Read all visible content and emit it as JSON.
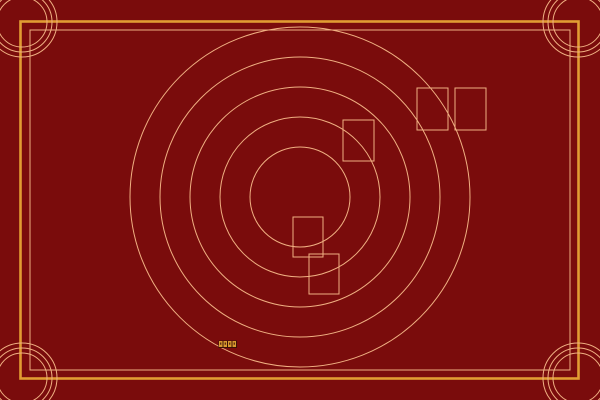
{
  "scene": {
    "width": 600,
    "height": 400,
    "background_color": "#7a0c0c",
    "line_color": "#f0b082",
    "accent_color": "#e19c33",
    "outer_border": {
      "x": 20.5,
      "y": 21.5,
      "width": 558,
      "height": 357,
      "stroke_width": 2.6
    },
    "inner_border": {
      "x": 30,
      "y": 30,
      "width": 540,
      "height": 340,
      "stroke_width": 1
    },
    "rings": {
      "cx": 300,
      "cy": 197,
      "radii": [
        50,
        80,
        110,
        140,
        170
      ],
      "stroke_width": 1
    },
    "corner_rosettes": {
      "radii": [
        25,
        30,
        35
      ],
      "stroke_width": 1,
      "centers": [
        {
          "cx": 22,
          "cy": 22
        },
        {
          "cx": 578,
          "cy": 22
        },
        {
          "cx": 22,
          "cy": 378
        },
        {
          "cx": 578,
          "cy": 378
        }
      ]
    },
    "cards": [
      {
        "x": 343,
        "y": 120,
        "width": 31,
        "height": 41
      },
      {
        "x": 417,
        "y": 88,
        "width": 31,
        "height": 42
      },
      {
        "x": 455,
        "y": 88,
        "width": 31,
        "height": 42
      },
      {
        "x": 293,
        "y": 217,
        "width": 30,
        "height": 40
      },
      {
        "x": 309,
        "y": 254,
        "width": 30,
        "height": 40
      }
    ],
    "tile_strip": {
      "x": 219,
      "y": 341,
      "tile_width": 3.5,
      "tile_height": 6,
      "pitch": 4.5,
      "count": 4,
      "strip_color": "#3a1206",
      "tile_color": "#d89a2e",
      "dot_color": "#42140a"
    }
  }
}
